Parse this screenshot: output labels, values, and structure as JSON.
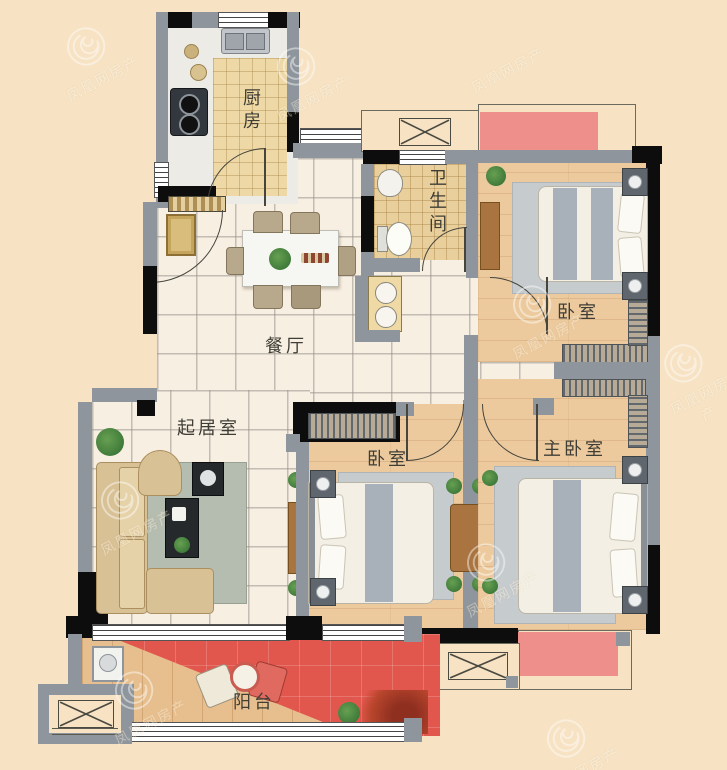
{
  "watermark": {
    "text": "凤凰网房产"
  },
  "rooms": {
    "kitchen": {
      "label": "厨房"
    },
    "bathroom": {
      "label": "卫生间"
    },
    "bedroom_top": {
      "label": "卧室"
    },
    "dining": {
      "label": "餐厅"
    },
    "living": {
      "label": "起居室"
    },
    "bedroom_mid": {
      "label": "卧室"
    },
    "master": {
      "label": "主卧室"
    },
    "balcony": {
      "label": "阳台"
    }
  },
  "colors": {
    "background": "#f7e3c4",
    "wall_gray": "#8e959c",
    "wall_black": "#0d0d0d",
    "bay_window_red": "#ef8f8c",
    "balcony_red": "#e2574d",
    "wood_floor": "#ecca9e",
    "tile_floor": "#f8efe3",
    "kitchen_tile": "#eed9a6",
    "rug_gray": "#c6cbce"
  }
}
